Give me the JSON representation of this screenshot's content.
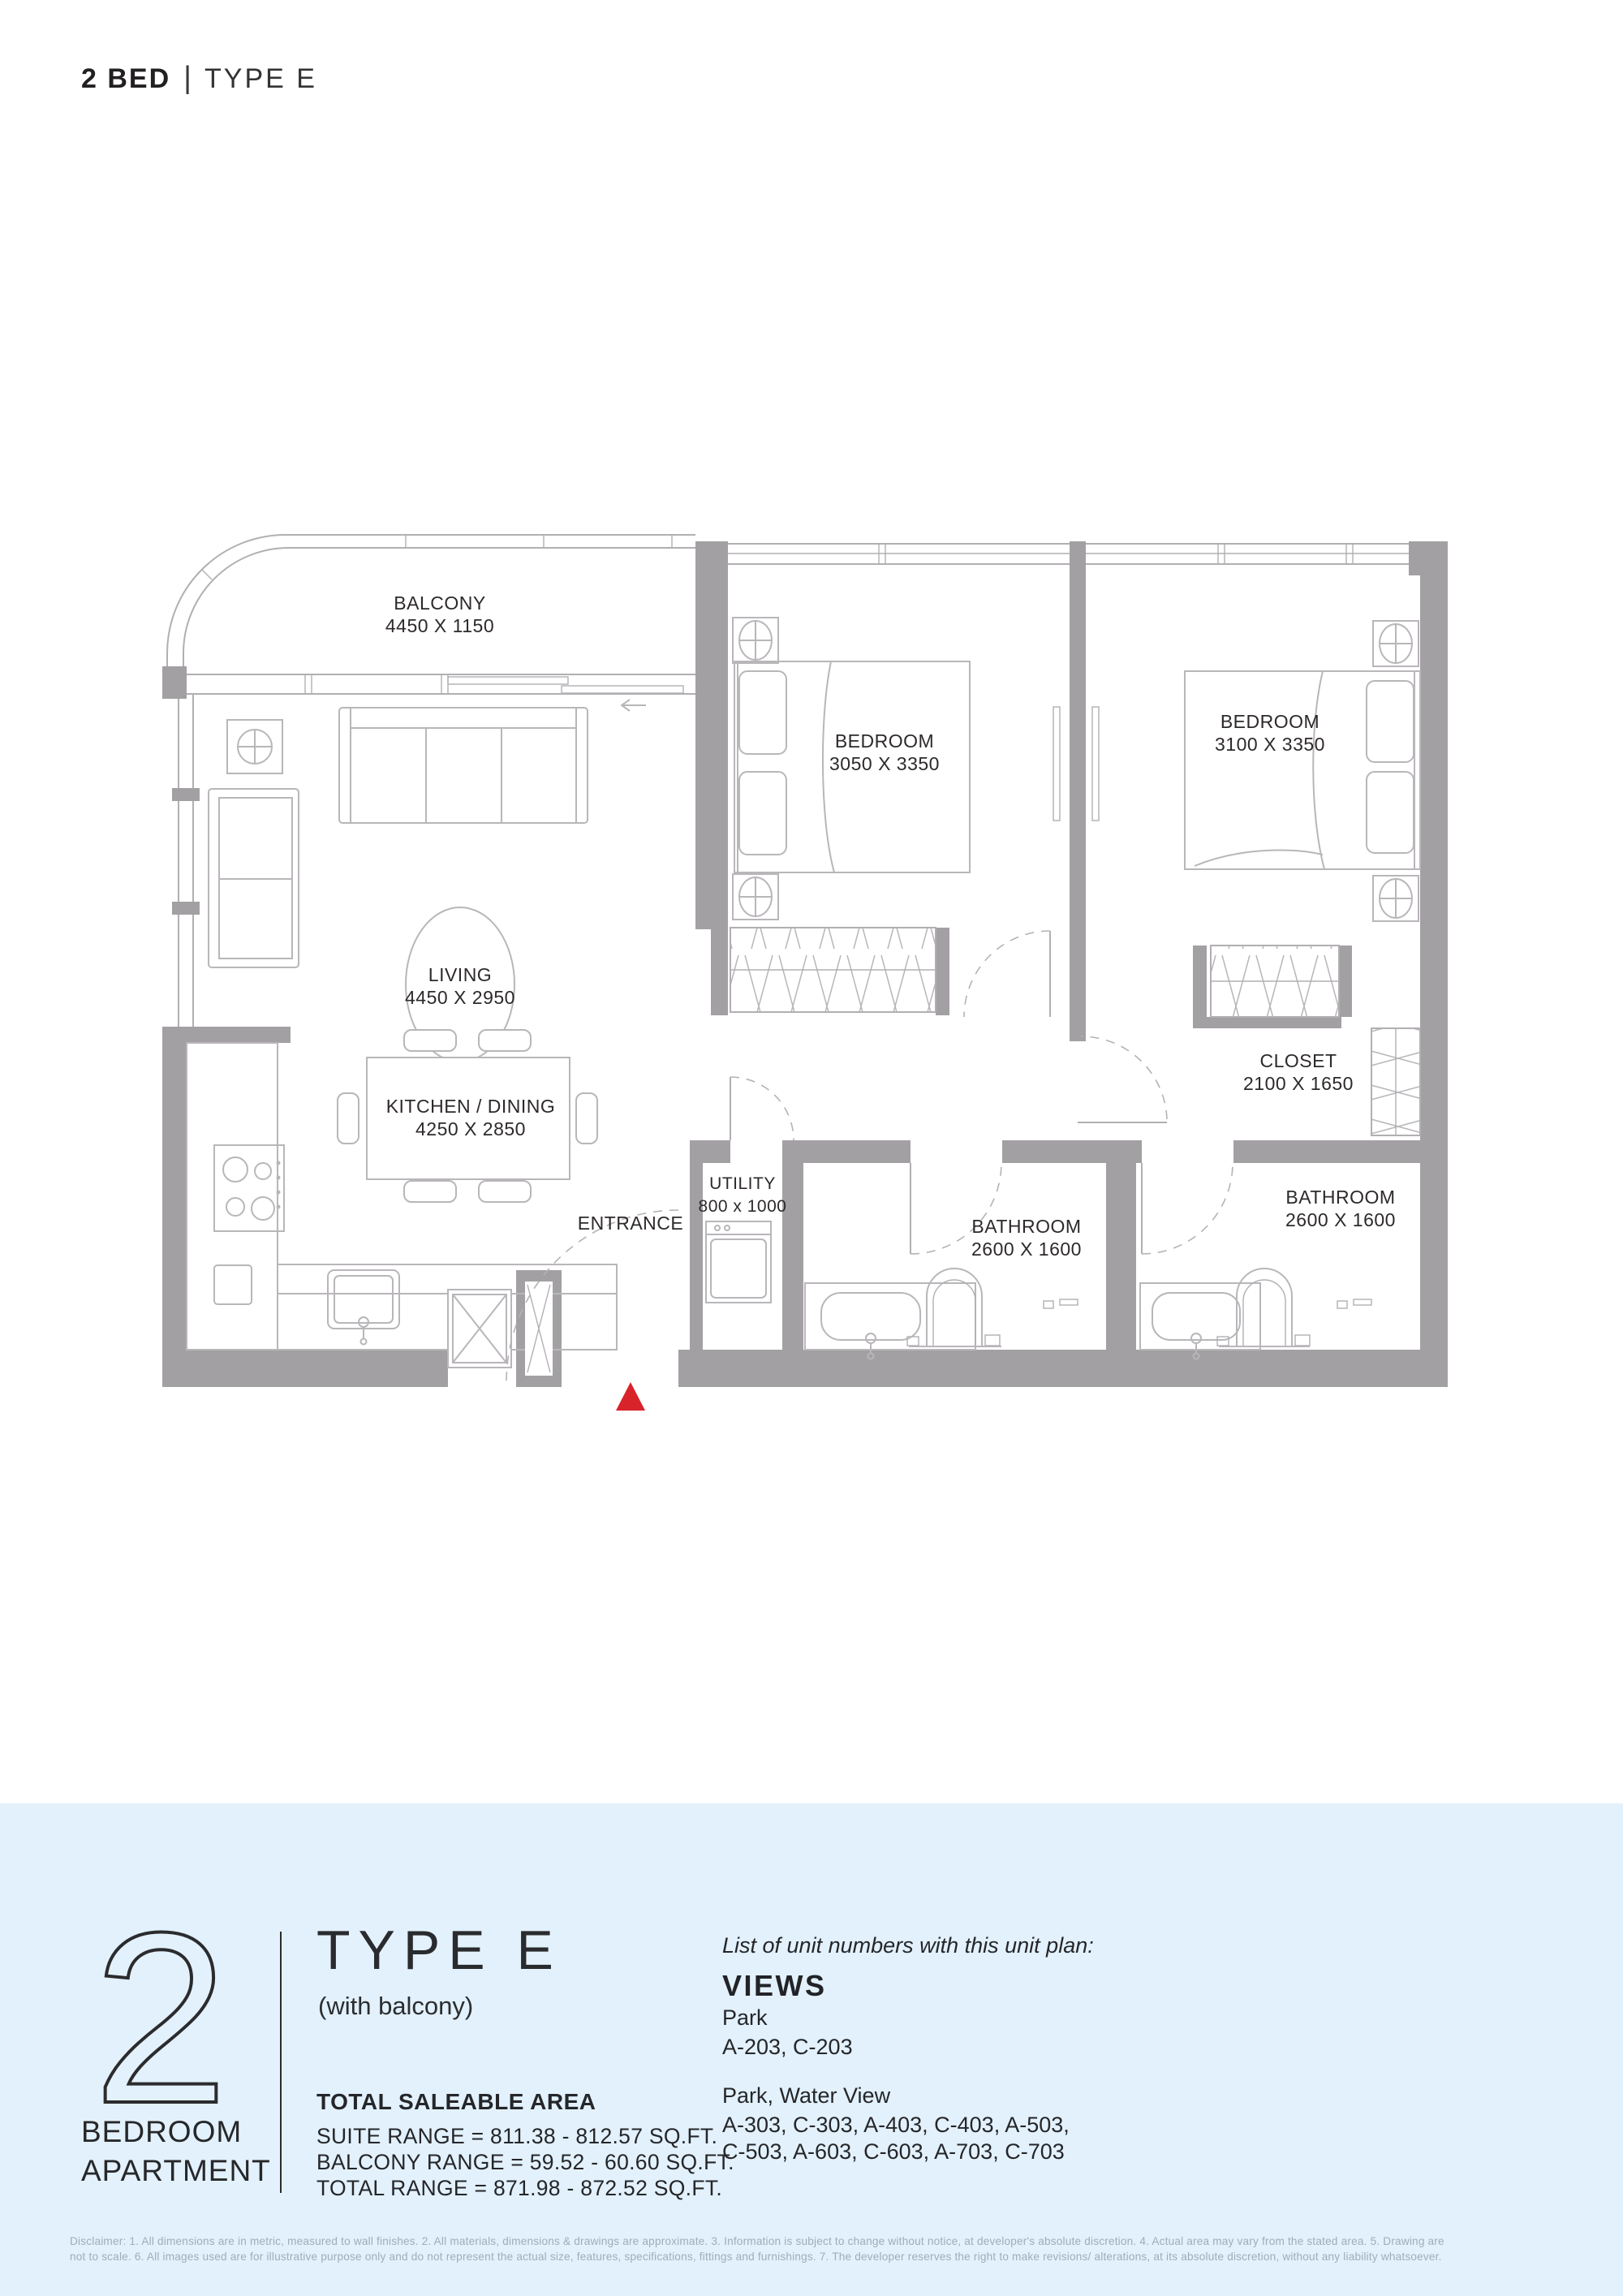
{
  "page": {
    "header": {
      "bold": "2 BED",
      "separator": "|",
      "light": "TYPE E"
    }
  },
  "plan": {
    "labels": {
      "balcony": {
        "name": "BALCONY",
        "dims": "4450 X 1150"
      },
      "living": {
        "name": "LIVING",
        "dims": "4450 X 2950"
      },
      "kitchen": {
        "name": "KITCHEN / DINING",
        "dims": "4250 X 2850"
      },
      "bedroom1": {
        "name": "BEDROOM",
        "dims": "3050 X 3350"
      },
      "bedroom2": {
        "name": "BEDROOM",
        "dims": "3100 X 3350"
      },
      "closet": {
        "name": "CLOSET",
        "dims": "2100 X 1650"
      },
      "bathroom1": {
        "name": "BATHROOM",
        "dims": "2600 X 1600"
      },
      "bathroom2": {
        "name": "BATHROOM",
        "dims": "2600 X 1600"
      },
      "utility": {
        "name": "UTILITY",
        "dims": "800 x 1000"
      },
      "entrance": "ENTRANCE"
    },
    "colors": {
      "wall": "#a3a0a4",
      "line": "#b2afb3",
      "text": "#2d292c",
      "marker": "#d8232a"
    }
  },
  "info": {
    "band_color": "#e2f1fb",
    "number": "2",
    "number_caption_line1": "BEDROOM",
    "number_caption_line2": "APARTMENT",
    "type_title": "TYPE E",
    "type_subtitle": "(with balcony)",
    "area_heading": "TOTAL SALEABLE AREA",
    "area_lines": [
      "SUITE RANGE = 811.38 - 812.57 SQ.FT.",
      "BALCONY RANGE = 59.52 - 60.60 SQ.FT.",
      "TOTAL RANGE = 871.98 - 872.52 SQ.FT."
    ],
    "units_intro": "List of unit numbers with this unit plan:",
    "views_heading": "VIEWS",
    "groups": [
      {
        "view": "Park",
        "units": [
          "A-203, C-203"
        ]
      },
      {
        "view": "Park, Water View",
        "units": [
          "A-303, C-303, A-403, C-403, A-503,",
          "C-503, A-603, C-603, A-703, C-703"
        ]
      }
    ]
  },
  "disclaimer": {
    "line1": "Disclaimer: 1. All dimensions are in metric, measured to wall finishes. 2. All materials, dimensions & drawings are approximate. 3. Information is subject to change without notice, at developer's absolute discretion. 4. Actual area may vary from the stated area. 5. Drawing are",
    "line2": "not to scale. 6. All images used are for illustrative purpose only and do not represent the actual size, features, specifications, fittings and furnishings. 7. The developer reserves the right to make revisions/ alterations, at its absolute discretion, without any liability whatsoever."
  }
}
